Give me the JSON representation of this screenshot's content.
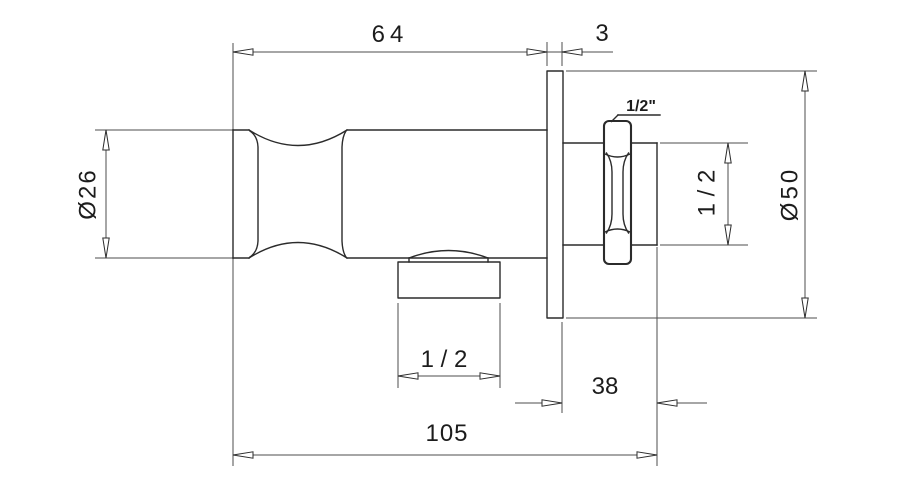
{
  "drawing": {
    "type": "technical-dimension-drawing",
    "subject": "wall-mounted shower outlet elbow with holder, side view",
    "background_color": "#ffffff",
    "object_line_color": "#2b2b2b",
    "dimension_line_color": "#4c4c4c",
    "text_color": "#1c1c1c",
    "labels": {
      "body_length": "64",
      "flange_thickness": "3",
      "body_diameter": "Ø26",
      "nut_thread": "1/2\"",
      "pipe_dim": "1 / 2",
      "flange_diameter": "Ø50",
      "outlet_thread": "1 / 2",
      "wall_to_end": "38",
      "overall_length": "105"
    }
  }
}
